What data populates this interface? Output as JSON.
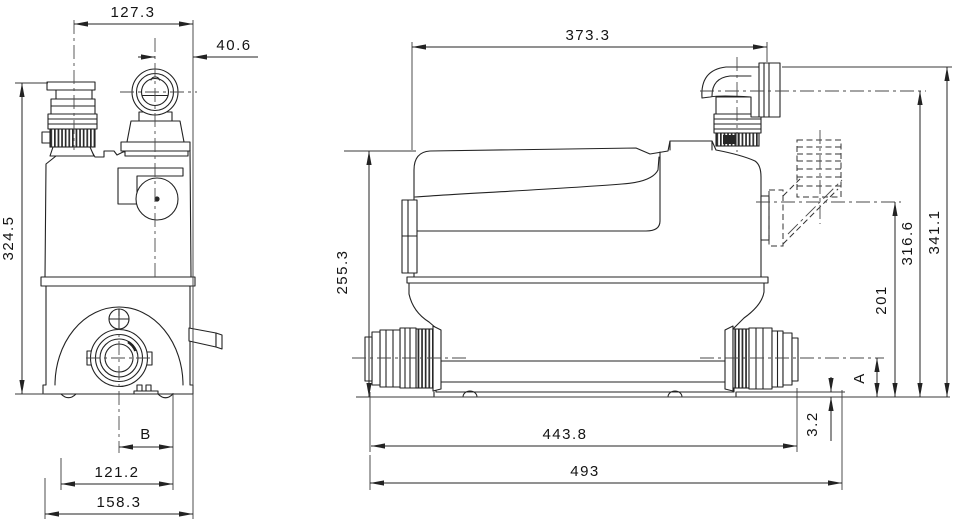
{
  "drawing": {
    "background": "#ffffff",
    "line_color": "#232323",
    "front_view": {
      "dims": {
        "top_width": "127.3",
        "outlet_offset": "40.6",
        "height": "324.5",
        "center_to_edge": "B",
        "foot_span": "121.2",
        "base_width": "158.3"
      }
    },
    "side_view": {
      "dims": {
        "top_length": "373.3",
        "body_height": "255.3",
        "alt_outlet_height": "201",
        "outlet_height": "316.6",
        "overall_height": "341.1",
        "inlet_height": "A",
        "base_clearance": "3.2",
        "connector_span": "443.8",
        "overall_length": "493"
      }
    }
  }
}
